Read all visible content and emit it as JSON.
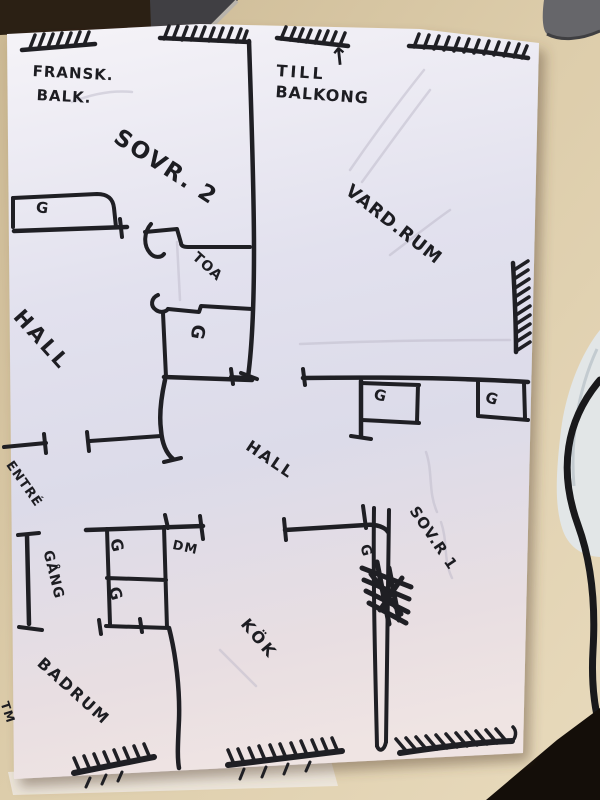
{
  "labels": {
    "fransk_balk_line1": "FRANSK.",
    "fransk_balk_line2": "BALK.",
    "sovr2": "SOVR. 2",
    "till": "TILL",
    "balkong": "BALKONG",
    "arrow_up": "↑",
    "vardrum": "VARD.RUM",
    "toa": "TOA",
    "hall_upper": "HALL",
    "hall_lower": "HALL",
    "entre": "ENTRÉ",
    "gang": "GÅNG",
    "dm": "DM",
    "sovr1": "SOV.R 1",
    "kok": "KÖK",
    "badrum": "BADRUM",
    "tm": "TM",
    "wardrobe": "G"
  },
  "colors": {
    "ink": "#1f1f24",
    "paper": "#e4e2ee",
    "desk": "#d8c7a5",
    "cable": "#19191b",
    "dark_corner": "#140e09"
  }
}
